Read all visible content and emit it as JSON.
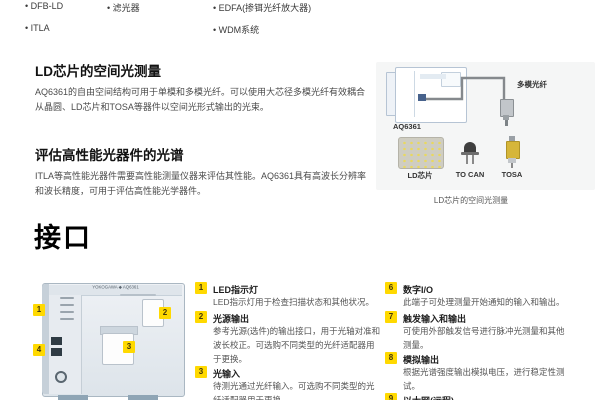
{
  "top_bullets": {
    "row1": [
      "DFB-LD",
      "滤光器",
      "EDFA(掺铒光纤放大器)"
    ],
    "row2": [
      "ITLA",
      "WDM系统"
    ]
  },
  "sections": [
    {
      "heading": "LD芯片的空间光测量",
      "body": "AQ6361的自由空间结构可用于单模和多模光纤。可以使用大芯径多模光纤有效耦合从晶圆、LD芯片和TOSA等器件以空间光形式输出的光束。"
    },
    {
      "heading": "评估高性能光器件的光谱",
      "body": "ITLA等高性能光器件需要高性能测量仪器来评估其性能。AQ6361具有高波长分辨率和波长精度，可用于评估高性能光学器件。"
    }
  ],
  "figure": {
    "device_label": "AQ6361",
    "fiber_label": "多模光纤",
    "component_labels": [
      "LD芯片",
      "TO CAN",
      "TOSA"
    ],
    "caption": "LD芯片的空间光测量"
  },
  "interface": {
    "heading": "接口",
    "brand": "YOKOGAWA ◆ AQ6361",
    "callouts": [
      "1",
      "2",
      "3",
      "4"
    ],
    "items_left": [
      {
        "num": "1",
        "title": "LED指示灯",
        "desc": "LED指示灯用于检查扫描状态和其他状况。"
      },
      {
        "num": "2",
        "title": "光源输出",
        "desc": "参考光源(选件)的输出接口，用于光轴对准和波长校正。可选购不同类型的光纤适配器用于更换。"
      },
      {
        "num": "3",
        "title": "光输入",
        "desc": "待测光通过光纤输入。可选购不同类型的光纤适配器用于更换。"
      }
    ],
    "items_right": [
      {
        "num": "6",
        "title": "数字I/O",
        "desc": "此端子可处理测量开始通知的输入和输出。"
      },
      {
        "num": "7",
        "title": "触发输入和输出",
        "desc": "可使用外部触发信号进行脉冲光测量和其他测量。"
      },
      {
        "num": "8",
        "title": "模拟输出",
        "desc": "根据光谱强度输出模拟电压，进行稳定性测试。"
      },
      {
        "num": "9",
        "title": "以太网(远程)",
        "desc": ""
      }
    ]
  },
  "colors": {
    "accent_yellow": "#ffd900",
    "figure_bg": "#f5f6f6"
  }
}
